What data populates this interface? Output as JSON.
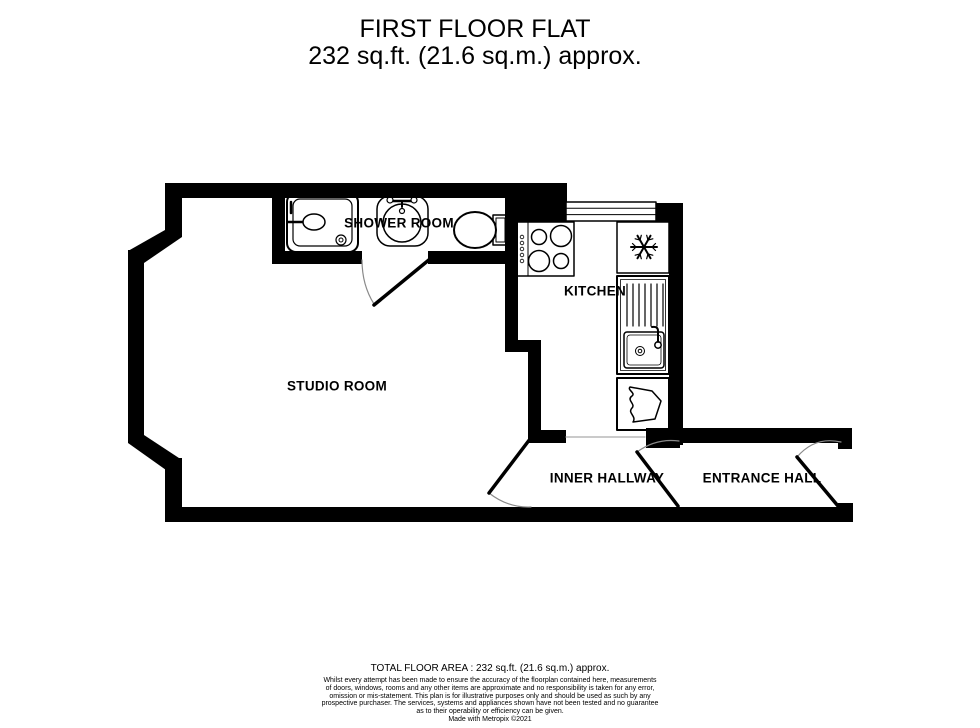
{
  "title": {
    "name": "FIRST FLOOR FLAT",
    "area": "232 sq.ft. (21.6 sq.m.) approx."
  },
  "rooms": [
    {
      "name": "SHOWER ROOM"
    },
    {
      "name": "KITCHEN"
    },
    {
      "name": "STUDIO ROOM"
    },
    {
      "name": "INNER HALLWAY"
    },
    {
      "name": "ENTRANCE HALL"
    }
  ],
  "fixtures": [
    "shower",
    "wash-basin",
    "toilet",
    "hob",
    "fridge-freezer",
    "sink-drainer",
    "kitchen-unit",
    "kitchen-window",
    "doors"
  ],
  "footer": {
    "total_area": "TOTAL FLOOR AREA : 232 sq.ft. (21.6 sq.m.) approx.",
    "disclaimer": "Whilst every attempt has been made to ensure the accuracy of the floorplan contained here, measurements\nof doors, windows, rooms and any other items are approximate and no responsibility is taken for any error,\nomission or mis-statement. This plan is for illustrative purposes only and should be used as such by any\nprospective purchaser. The services, systems and appliances shown have not been tested and no guarantee\nas to their operability or efficiency can be given.",
    "credit": "Made with Metropix ©2021"
  },
  "colors": {
    "walls": "#000000",
    "background": "#ffffff",
    "door_arc": "#8a8a8a",
    "room_divider": "#aaaaaa"
  }
}
